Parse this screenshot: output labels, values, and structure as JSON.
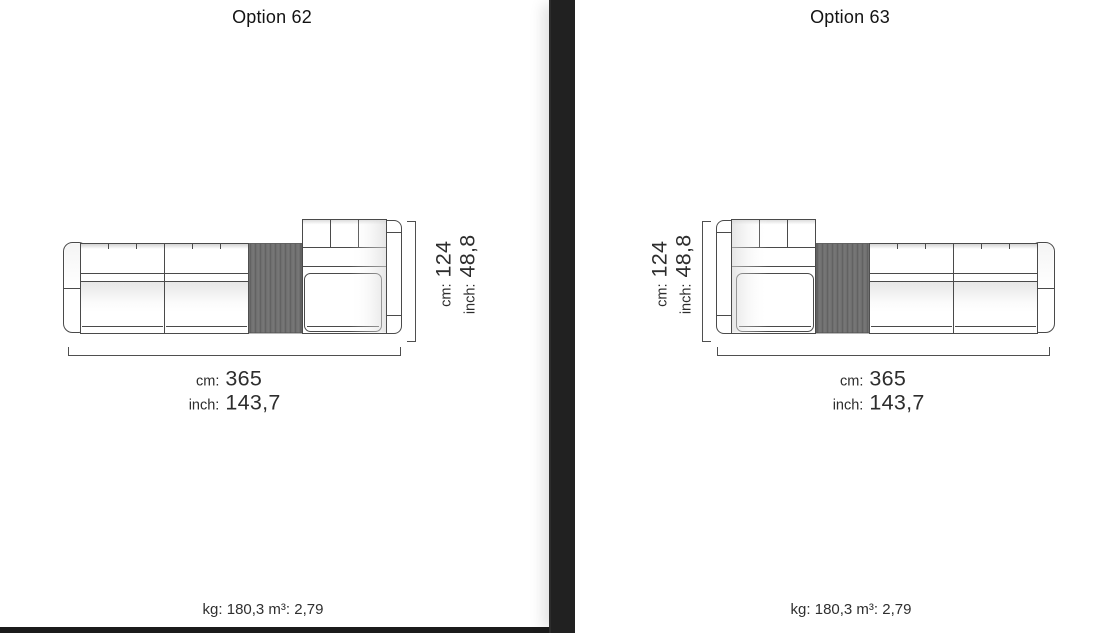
{
  "colors": {
    "divider": "#212121",
    "bottom_bar": "#1b1b1b",
    "line": "#4a4a4a",
    "table_fill": "#6f6f6f",
    "dim_text": "#2d2d2d",
    "title_text": "#131313",
    "footnote_text": "#2f2f2f"
  },
  "options": [
    {
      "title": "Option 62",
      "height_dimension": {
        "cm_label": "cm:",
        "cm_value": "124",
        "inch_label": "inch:",
        "inch_value": "48,8"
      },
      "width_dimension": {
        "cm_label": "cm:",
        "cm_value": "365",
        "inch_label": "inch:",
        "inch_value": "143,7"
      },
      "weight_volume": "kg: 180,3 m³: 2,79"
    },
    {
      "title": "Option 63",
      "height_dimension": {
        "cm_label": "cm:",
        "cm_value": "124",
        "inch_label": "inch:",
        "inch_value": "48,8"
      },
      "width_dimension": {
        "cm_label": "cm:",
        "cm_value": "365",
        "inch_label": "inch:",
        "inch_value": "143,7"
      },
      "weight_volume": "kg: 180,3 m³: 2,79"
    }
  ]
}
